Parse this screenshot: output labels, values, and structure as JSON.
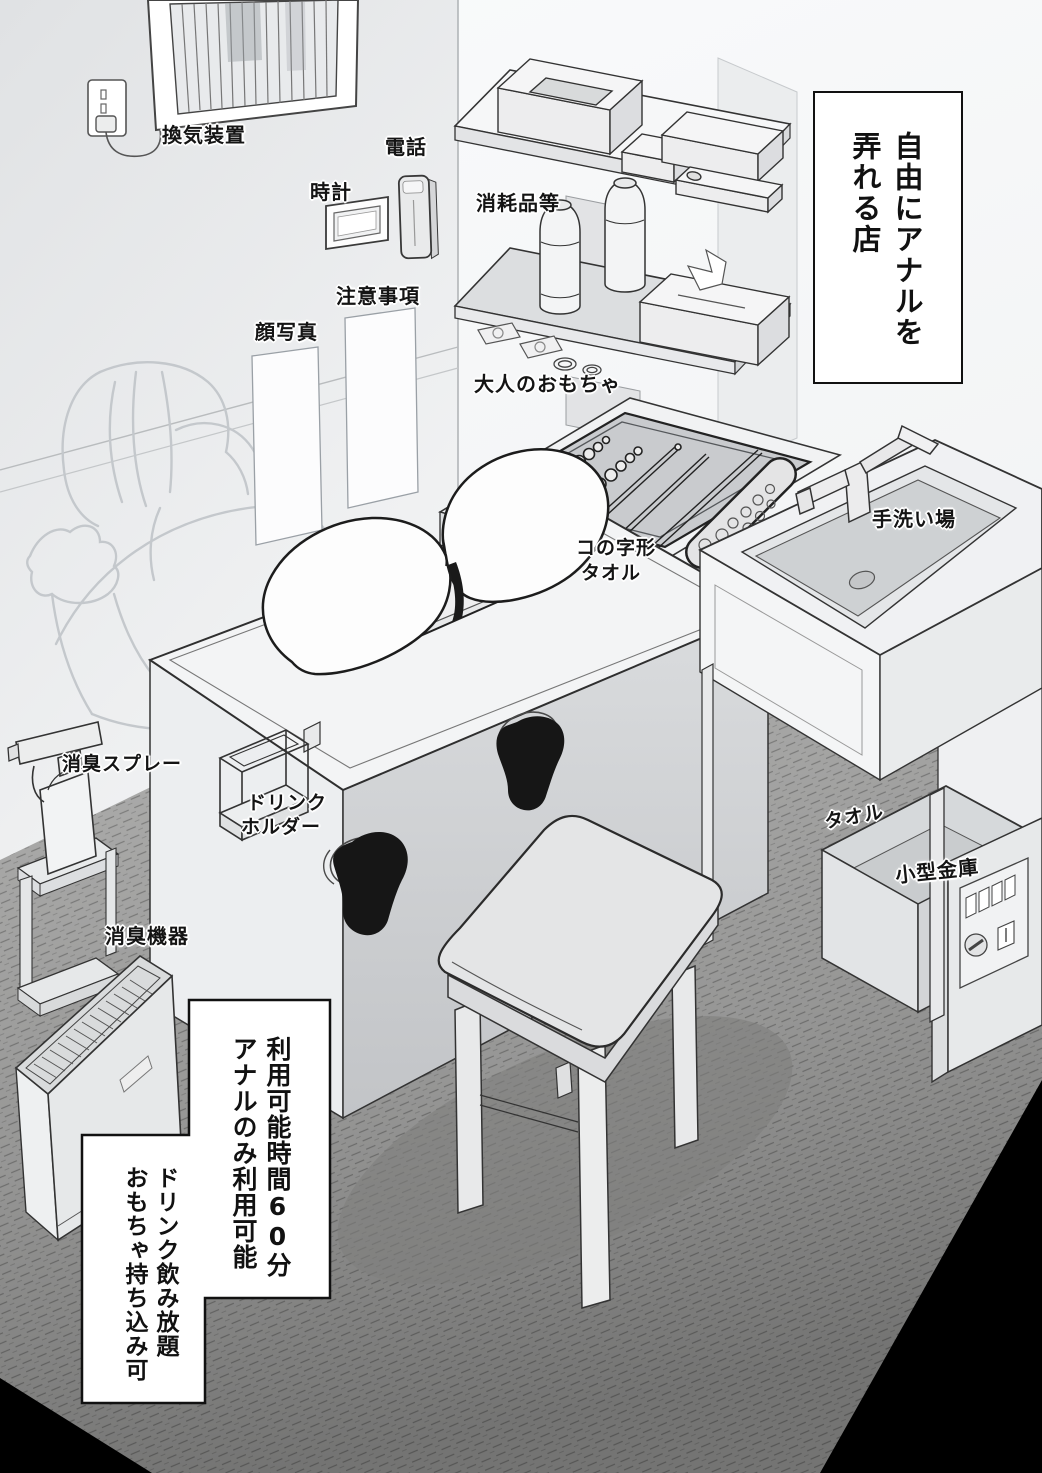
{
  "title": {
    "line1": "自由にアナルを",
    "line2": "弄れる店"
  },
  "labels": {
    "ventilation": "換気装置",
    "clock": "時計",
    "phone": "電話",
    "notice": "注意事項",
    "face_photo": "顔写真",
    "consumables": "消耗品等",
    "adult_toys": "大人のおもちゃ",
    "u_towel_1": "コの字形",
    "u_towel_2": "タオル",
    "hand_wash": "手洗い場",
    "spray": "消臭スプレー",
    "drink_1": "ドリンク",
    "drink_2": "ホルダー",
    "towel": "タオル",
    "safe": "小型金庫",
    "deodorizer": "消臭機器"
  },
  "info_box_1": {
    "line1": "利用可能時間60分",
    "line2": "アナルのみ利用可能"
  },
  "info_box_2": {
    "line1": "ドリンク飲み放題",
    "line2": "おもちゃ持ち込み可"
  },
  "colors": {
    "paper": "#ffffff",
    "ink": "#111111",
    "wall": "#f4f5f6",
    "carpet": "#9a9a9a",
    "corner_black": "#000000"
  }
}
